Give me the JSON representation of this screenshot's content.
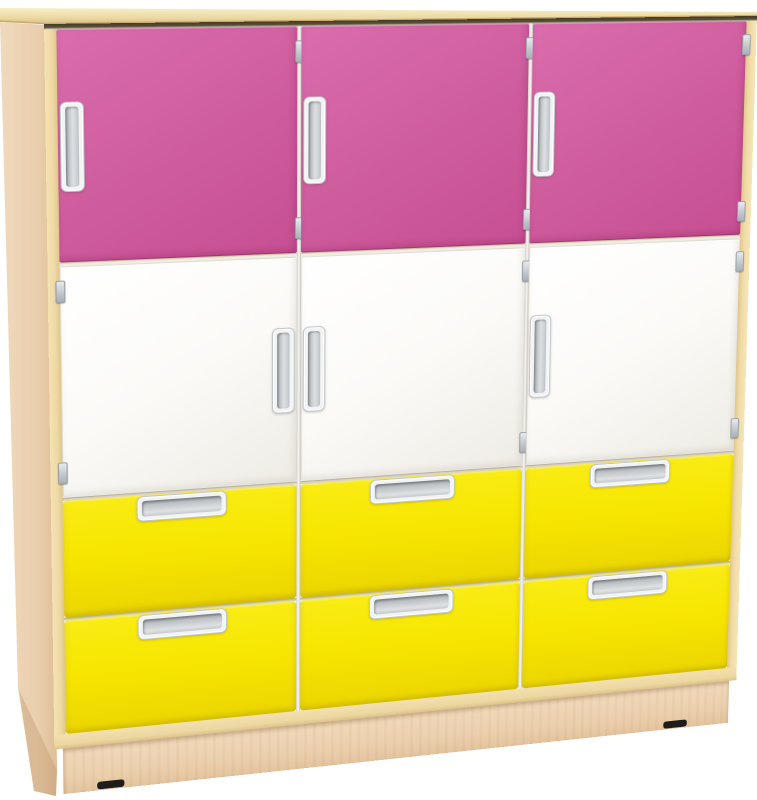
{
  "scene": {
    "type": "product-photo",
    "subject": "Three-column children's storage cabinet with pink top doors, white middle doors and yellow drawers on a maple frame",
    "background_color": "#ffffff"
  },
  "palette": {
    "wood_top_light": "#f7edc6",
    "wood_top_dark": "#d9bf82",
    "wood_frame": "#f2dfab",
    "wood_side_light": "#f0d9bd",
    "wood_side_dark": "#ddbd96",
    "wood_plinth": "#ecd0ae",
    "door_pink": "#d05f9f",
    "door_pink_light": "#da6dad",
    "door_pink_dark": "#c64f92",
    "door_white": "#fbfaf7",
    "drawer_yellow": "#f7e600",
    "drawer_yellow_dark": "#ebd600",
    "handle_bezel_silver": "#f2f3f4",
    "handle_recess_silver": "#b9bec2",
    "hinge_silver": "#cdd1d4",
    "top_shadow_brown": "#453a28",
    "feet_black": "#1e1d1b"
  },
  "cabinet": {
    "columns": 3,
    "rows": [
      {
        "name": "top-door-row",
        "kind": "doors",
        "color": "pink",
        "items": [
          {
            "handle_side": "left",
            "hinge_side": "right"
          },
          {
            "handle_side": "left",
            "hinge_side": "right"
          },
          {
            "handle_side": "left",
            "hinge_side": "right"
          }
        ]
      },
      {
        "name": "middle-door-row",
        "kind": "doors",
        "color": "white",
        "items": [
          {
            "handle_side": "right",
            "hinge_side": "left"
          },
          {
            "handle_side": "left",
            "hinge_side": "right"
          },
          {
            "handle_side": "left",
            "hinge_side": "right"
          }
        ]
      },
      {
        "name": "upper-drawer-row",
        "kind": "drawers",
        "color": "yellow",
        "items": [
          {},
          {},
          {}
        ]
      },
      {
        "name": "lower-drawer-row",
        "kind": "drawers",
        "color": "yellow",
        "items": [
          {},
          {},
          {}
        ]
      }
    ],
    "door_count": 6,
    "drawer_count": 6,
    "handle_count": 12,
    "visible_feet": 2
  }
}
